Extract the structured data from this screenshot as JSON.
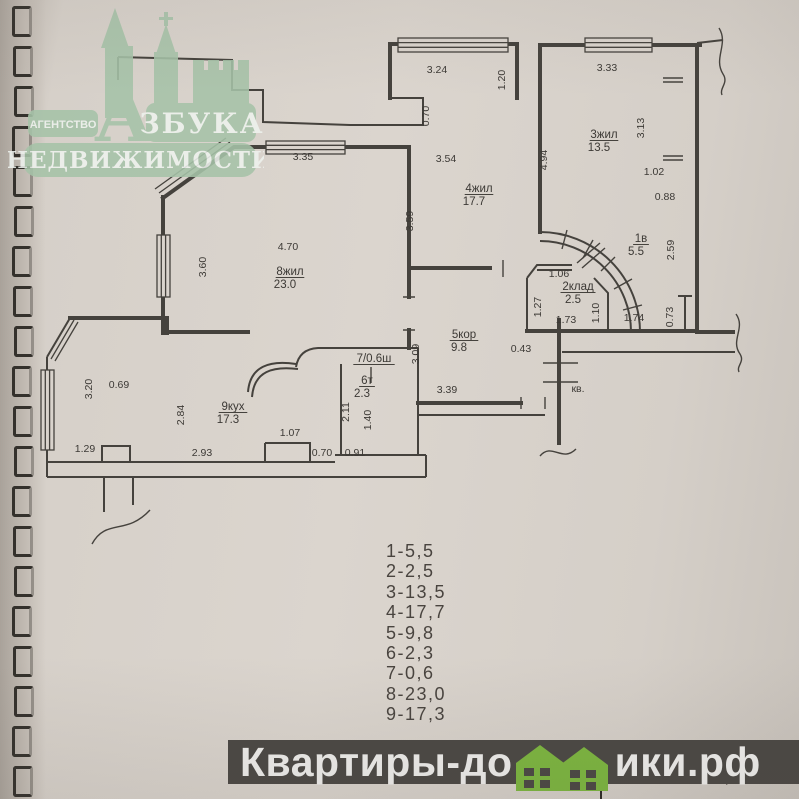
{
  "colors": {
    "paper": "#d9d3cc",
    "ink": "#45423d",
    "logo_green": "#a6c3a8",
    "banner_bg": "#4a4743",
    "house_green": "#7cb63f"
  },
  "logo": {
    "agency": "АГЕНТСТВО",
    "brand_initial": "А",
    "brand_rest": "ЗБУКА",
    "brand_line2": "НЕДВИЖИМОСТИ"
  },
  "plan": {
    "rooms": [
      {
        "name": "3жил",
        "area": "13.5",
        "x": 604,
        "y": 138
      },
      {
        "name": "4жил",
        "area": "17.7",
        "x": 479,
        "y": 192
      },
      {
        "name": "1в",
        "area": "5.5",
        "x": 641,
        "y": 242
      },
      {
        "name": "8жил",
        "area": "23.0",
        "x": 290,
        "y": 275
      },
      {
        "name": "2клад",
        "area": "2.5",
        "x": 578,
        "y": 290
      },
      {
        "name": "5кор",
        "area": "9.8",
        "x": 464,
        "y": 338
      },
      {
        "name": "7/0.6ш",
        "area": "",
        "x": 374,
        "y": 362
      },
      {
        "name": "6т",
        "area": "2.3",
        "x": 367,
        "y": 384
      },
      {
        "name": "9кух",
        "area": "17.3",
        "x": 233,
        "y": 410
      }
    ],
    "dims": [
      {
        "t": "3.24",
        "x": 437,
        "y": 73,
        "r": 0
      },
      {
        "t": "1.20",
        "x": 505,
        "y": 80,
        "r": 1
      },
      {
        "t": "3.33",
        "x": 607,
        "y": 71,
        "r": 0
      },
      {
        "t": "0.70",
        "x": 429,
        "y": 116,
        "r": 1
      },
      {
        "t": "3.13",
        "x": 644,
        "y": 128,
        "r": 1
      },
      {
        "t": "3.35",
        "x": 303,
        "y": 160,
        "r": 0
      },
      {
        "t": "3.54",
        "x": 446,
        "y": 162,
        "r": 0
      },
      {
        "t": "4.94",
        "x": 547,
        "y": 160,
        "r": 1
      },
      {
        "t": "1.02",
        "x": 654,
        "y": 175,
        "r": 0
      },
      {
        "t": "0.88",
        "x": 665,
        "y": 200,
        "r": 0
      },
      {
        "t": "3.59",
        "x": 413,
        "y": 221,
        "r": 1
      },
      {
        "t": "4.70",
        "x": 288,
        "y": 250,
        "r": 0
      },
      {
        "t": "3.60",
        "x": 206,
        "y": 267,
        "r": 1
      },
      {
        "t": "2.59",
        "x": 674,
        "y": 250,
        "r": 1
      },
      {
        "t": "1.06",
        "x": 559,
        "y": 277,
        "r": 0
      },
      {
        "t": "1.27",
        "x": 541,
        "y": 307,
        "r": 1
      },
      {
        "t": "1.73",
        "x": 566,
        "y": 323,
        "r": 0
      },
      {
        "t": "1.10",
        "x": 599,
        "y": 313,
        "r": 1
      },
      {
        "t": "1.74",
        "x": 634,
        "y": 321,
        "r": 0
      },
      {
        "t": "0.73",
        "x": 673,
        "y": 317,
        "r": 1
      },
      {
        "t": "3.09",
        "x": 419,
        "y": 354,
        "r": 1
      },
      {
        "t": "0.43",
        "x": 521,
        "y": 352,
        "r": 0
      },
      {
        "t": "3.20",
        "x": 92,
        "y": 389,
        "r": 1
      },
      {
        "t": "0.69",
        "x": 119,
        "y": 388,
        "r": 0
      },
      {
        "t": "2.84",
        "x": 184,
        "y": 415,
        "r": 1
      },
      {
        "t": "3.39",
        "x": 447,
        "y": 393,
        "r": 0
      },
      {
        "t": "2.11",
        "x": 349,
        "y": 412,
        "r": 1
      },
      {
        "t": "1.40",
        "x": 371,
        "y": 420,
        "r": 1
      },
      {
        "t": "1.07",
        "x": 290,
        "y": 436,
        "r": 0
      },
      {
        "t": "1.29",
        "x": 85,
        "y": 452,
        "r": 0
      },
      {
        "t": "2.93",
        "x": 202,
        "y": 456,
        "r": 0
      },
      {
        "t": "0.70",
        "x": 322,
        "y": 456,
        "r": 0
      },
      {
        "t": "0.91",
        "x": 355,
        "y": 456,
        "r": 0
      },
      {
        "t": "кв.",
        "x": 578,
        "y": 392,
        "r": 0
      }
    ]
  },
  "legend": {
    "items": [
      "1-5,5",
      "2-2,5",
      "3-13,5",
      "4-17,7",
      "5-9,8",
      "6-2,3",
      "7-0,6",
      "8-23,0",
      "9-17,3"
    ]
  },
  "footer": {
    "site_prefix": "Квартиры-до",
    "site_suffix": "ики.рф",
    "stamp_line1": "Смоленский филиал ФГУП",
    "stamp_line2": "\"Ростехинвентаризация\""
  }
}
